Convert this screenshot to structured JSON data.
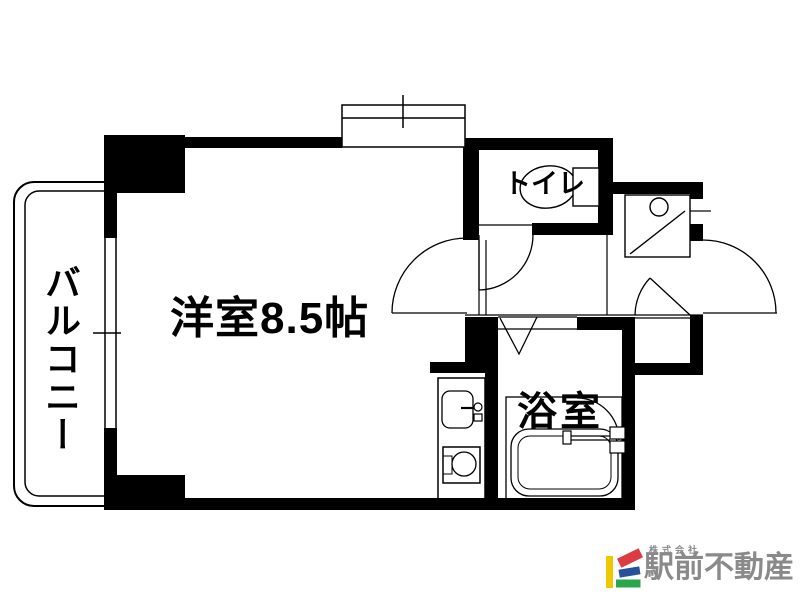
{
  "floorplan": {
    "wall_color": "#000000",
    "background_color": "#ffffff",
    "labels": {
      "main_room": "洋室8.5帖",
      "balcony": "バルコニー",
      "toilet": "トイレ",
      "bathroom": "浴室"
    }
  },
  "branding": {
    "company_prefix": "株式会社",
    "company_name": "駅前不動産",
    "text_color": "#8a8a8a",
    "logo_colors": {
      "yellow": "#eec800",
      "red": "#dc3c41",
      "blue": "#27509e",
      "green": "#2aa64b"
    }
  }
}
